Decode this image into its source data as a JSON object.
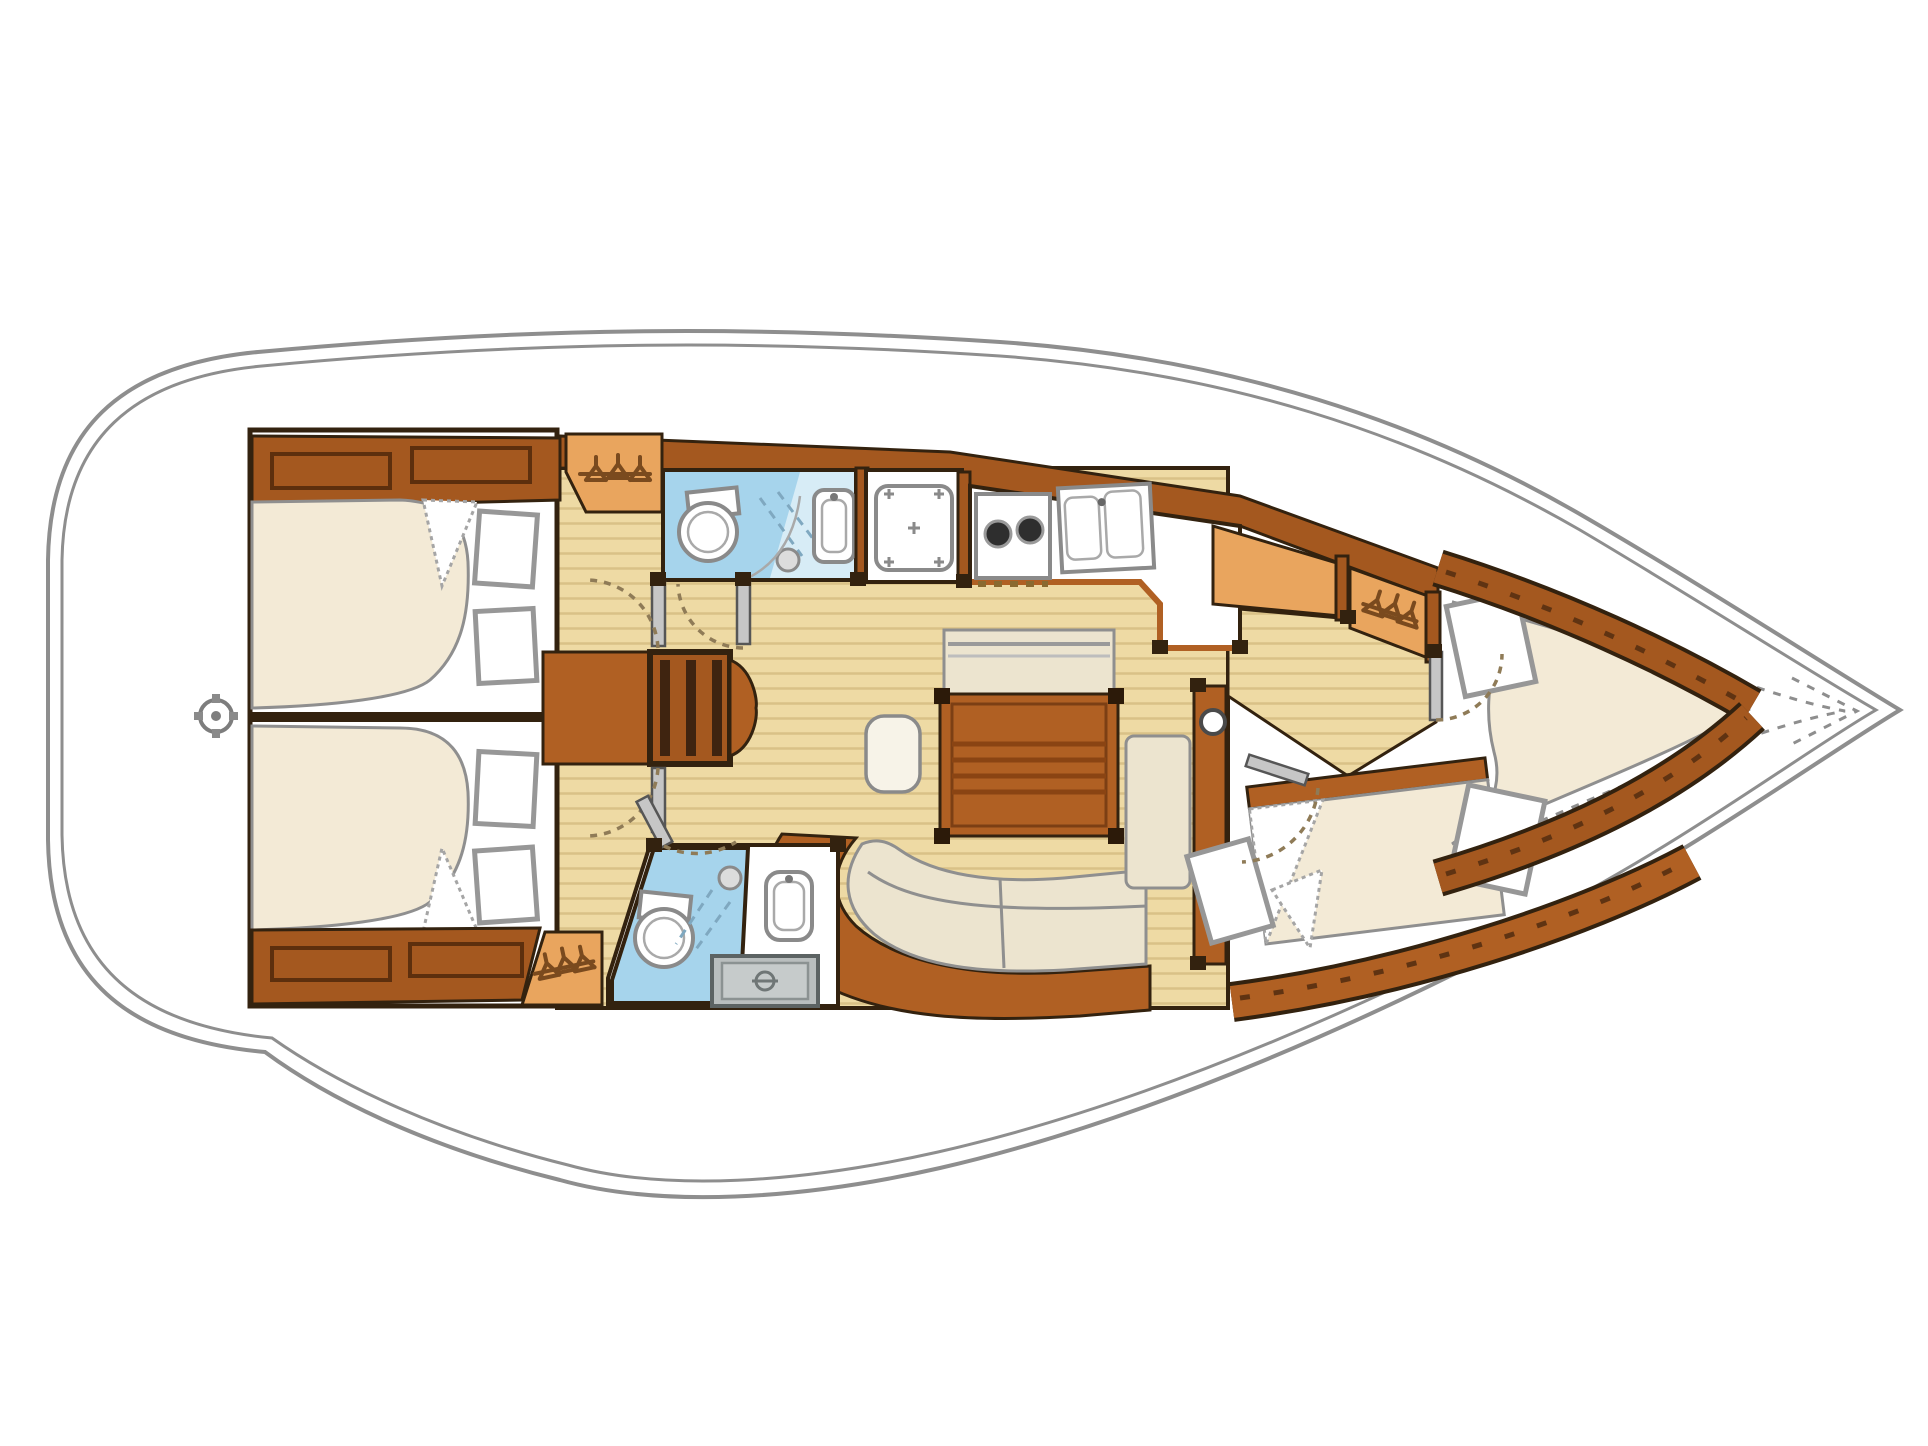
{
  "title": "Sailing yacht interior layout plan (4 cabins, 2 heads)",
  "diagram_type": "boat-floor-plan",
  "orientation": {
    "bow": "right",
    "stern": "left"
  },
  "colors": {
    "hull_outline": "#8e8e8e",
    "interior_outline": "#33220f",
    "wood_dark": "#a4581f",
    "wood_mid": "#b06023",
    "wood_light": "#e9a55e",
    "floor": "#eedaa4",
    "floor_line": "#d9c187",
    "bed": "#f3ead6",
    "cushion": "#ece4cf",
    "pillow": "#ffffff",
    "head_blue": "#a6d4ec",
    "fixture_gray": "#b9bebe",
    "door_gray": "#c6c6c6",
    "arc_color": "#8f7b57"
  },
  "rooms": [
    {
      "id": "aft-cabin-port",
      "label": "Aft double cabin (port)"
    },
    {
      "id": "aft-cabin-starboard",
      "label": "Aft double cabin (starboard)"
    },
    {
      "id": "companionway",
      "label": "Companionway steps over engine box"
    },
    {
      "id": "aft-head",
      "label": "Aft head with separate shower stall"
    },
    {
      "id": "galley",
      "label": "Galley: stove, double sink, counter"
    },
    {
      "id": "saloon",
      "label": "Saloon with folding table and curved settee"
    },
    {
      "id": "chart-table",
      "label": "Chart table"
    },
    {
      "id": "forward-head",
      "label": "Second head with shower"
    },
    {
      "id": "forward-lower-cabin",
      "label": "Forward double cabin (starboard)"
    },
    {
      "id": "forward-vberth-cabin",
      "label": "Forward V-berth cabin"
    },
    {
      "id": "hanging-lockers",
      "label": "Hanging lockers (3)"
    },
    {
      "id": "anchor-locker",
      "label": "Bow anchor locker"
    }
  ],
  "icons": [
    "clothes-hanger-icon",
    "toilet-icon",
    "sink-icon",
    "shower-head-icon",
    "stove-burner-icon",
    "steering-fitting-icon",
    "mast-icon"
  ]
}
